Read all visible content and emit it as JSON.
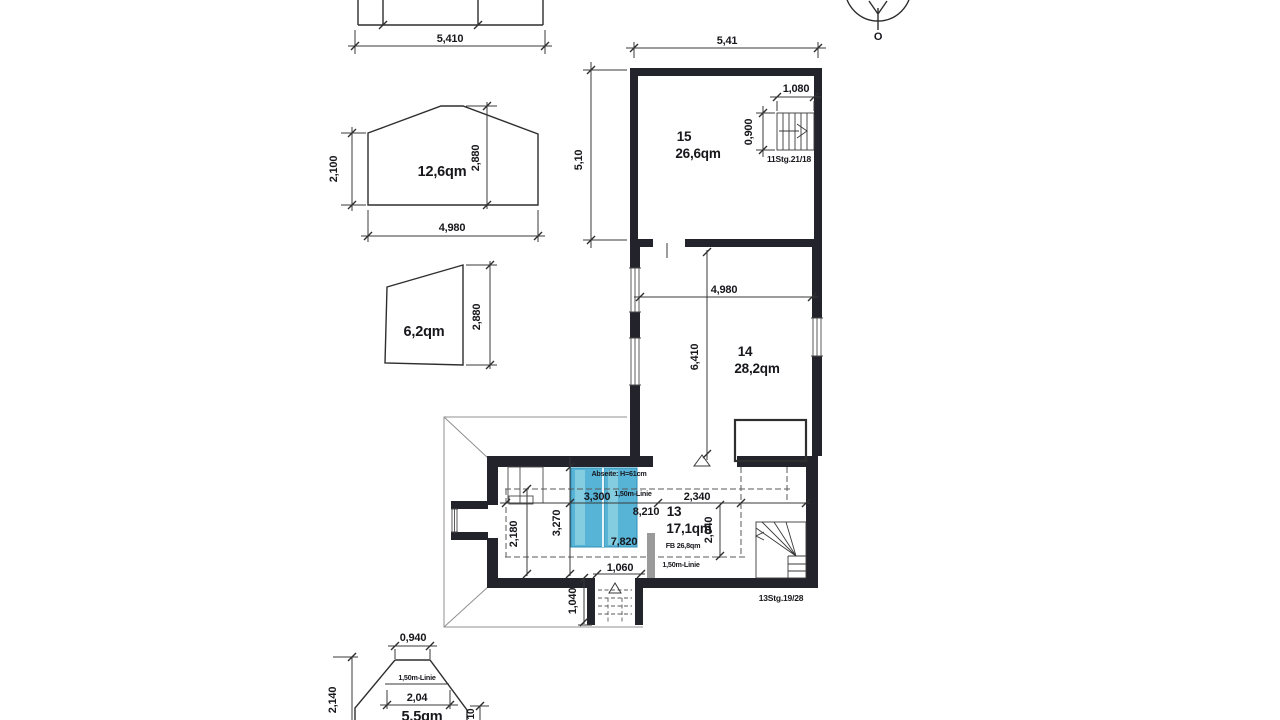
{
  "colors": {
    "wall": "#23232b",
    "line": "#2e2e2e",
    "highlight_blue": "#57b4d7",
    "highlight_blue_light": "#84cce0",
    "column_gray": "#9a9a9a"
  },
  "north_indicator": {
    "label": "O"
  },
  "top_elevation": {
    "dim_width": "5,410"
  },
  "gable_elevation": {
    "area": "12,6qm",
    "dim_height_left": "2,100",
    "dim_height_ridge": "2,880",
    "dim_width": "4,980"
  },
  "side_elevation": {
    "area": "6,2qm",
    "dim_height": "2,880"
  },
  "bottom_elevation": {
    "area": "5,5qm",
    "dim_top": "0,940",
    "line_label": "1,50m-Linie",
    "dim_width": "2,04",
    "dim_height": "2,140",
    "dim_right": "10"
  },
  "plan": {
    "dim_top": "5,41",
    "dim_left": "5,10",
    "room15": {
      "number": "15",
      "area": "26,6qm",
      "stair_label": "11Stg.21/18",
      "stair_dim_width": "1,080",
      "stair_dim_depth": "0,900"
    },
    "room14": {
      "number": "14",
      "area": "28,2qm",
      "dim_width": "4,980",
      "dim_height": "6,410"
    },
    "room13": {
      "number": "13",
      "area": "17,1qm",
      "floor_area": "FB 26,8qm",
      "abseite_note": "Abseite: H=61cm",
      "line_label_upper": "1,50m-Linie",
      "line_label_lower": "1,50m-Linie",
      "dim_3300": "3,300",
      "dim_2340": "2,340",
      "dim_8210": "8,210",
      "dim_7820": "7,820",
      "dim_2040": "2,040",
      "dim_3270": "3,270",
      "dim_2180": "2,180",
      "dim_1060": "1,060",
      "dim_1040": "1,040",
      "stair_label": "13Stg.19/28"
    }
  }
}
